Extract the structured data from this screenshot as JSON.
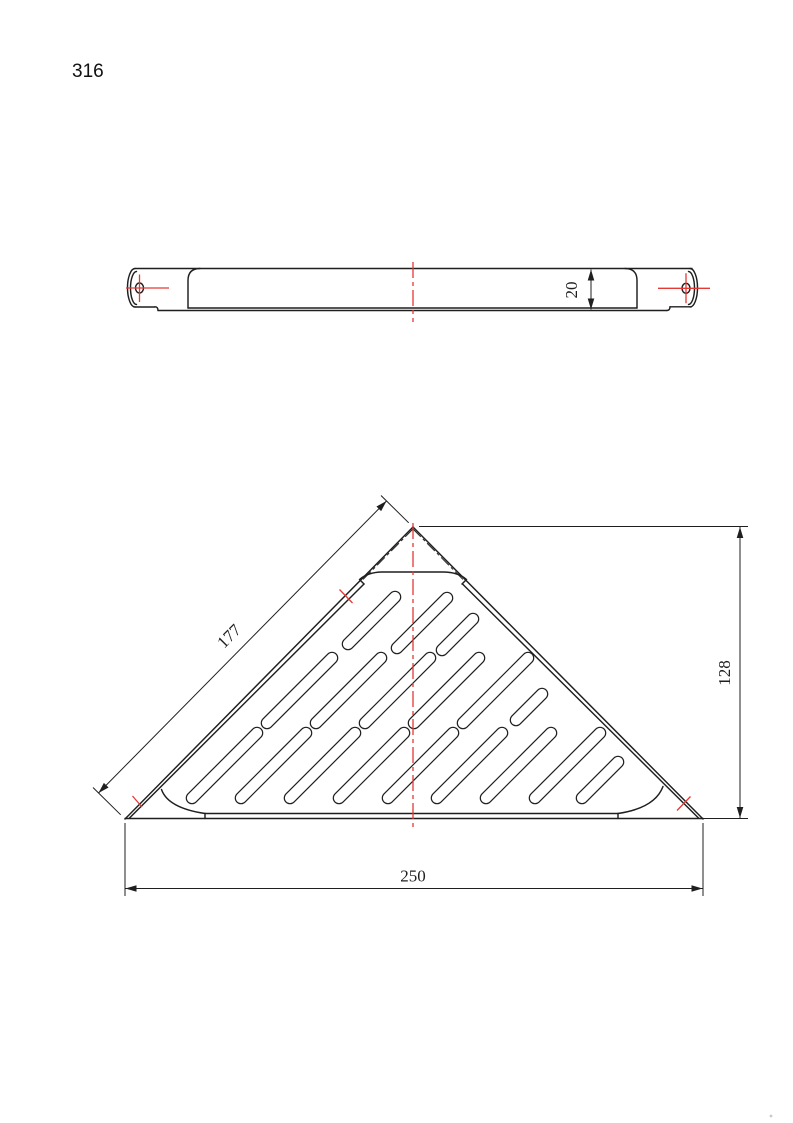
{
  "page": {
    "number": "316"
  },
  "colors": {
    "line": "#1f1f1f",
    "red": "#e53935",
    "background": "#ffffff"
  },
  "drawing": {
    "type": "technical-orthographic-drawing",
    "subject": "triangular corner shelf with drain slots",
    "views": [
      "side-profile-view",
      "plan-view"
    ]
  },
  "side_view": {
    "thickness_dim": {
      "value": "20"
    },
    "mounting_holes": 2,
    "has_center_line": true
  },
  "top_view": {
    "edge_dim": {
      "value": "177"
    },
    "height_dim": {
      "value": "128"
    },
    "width_dim": {
      "value": "250"
    },
    "slot_rows": [
      3,
      6,
      9
    ],
    "slots": [
      [
        348,
        644,
        47
      ],
      [
        397,
        648,
        50
      ],
      [
        442,
        650,
        31
      ],
      [
        267,
        723,
        65
      ],
      [
        316,
        723,
        65
      ],
      [
        365,
        723,
        65
      ],
      [
        414,
        723,
        65
      ],
      [
        463,
        723,
        65
      ],
      [
        516,
        720,
        26
      ],
      [
        192,
        798,
        65
      ],
      [
        241,
        798,
        65
      ],
      [
        290,
        798,
        65
      ],
      [
        339,
        798,
        65
      ],
      [
        388,
        798,
        65
      ],
      [
        437,
        798,
        65
      ],
      [
        486,
        798,
        65
      ],
      [
        535,
        798,
        65
      ],
      [
        582,
        798,
        36
      ]
    ]
  }
}
